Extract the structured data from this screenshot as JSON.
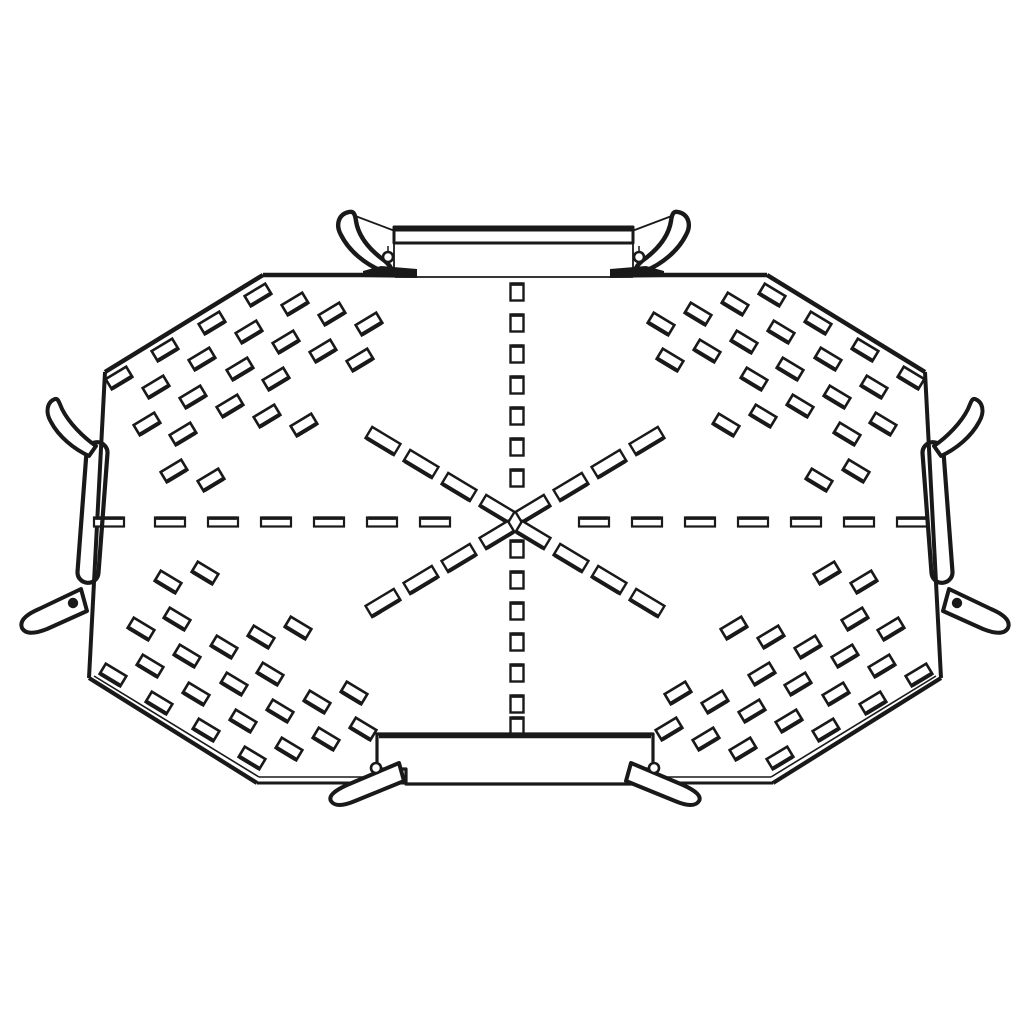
{
  "drawing": {
    "description": "black-and-white technical line illustration of a four-way perforated cable-tray crossover plate with edge couplers",
    "ink": "#191919",
    "background": "#ffffff",
    "canvas": {
      "width": 1030,
      "height": 1030
    },
    "outline_segments": [
      [
        263,
        275,
        395,
        275,
        4.5
      ],
      [
        633,
        275,
        767,
        275,
        4.5
      ],
      [
        395,
        277,
        633,
        277,
        1.8
      ],
      [
        263,
        275,
        105,
        372,
        4.5
      ],
      [
        767,
        275,
        925,
        372,
        4.5
      ],
      [
        105,
        372,
        89,
        678,
        4
      ],
      [
        925,
        372,
        941,
        678,
        4
      ],
      [
        89,
        678,
        257,
        783,
        4.2
      ],
      [
        941,
        678,
        773,
        783,
        4.2
      ],
      [
        94,
        676,
        259,
        777,
        1.6
      ],
      [
        936,
        676,
        771,
        777,
        1.6
      ],
      [
        259,
        777,
        771,
        777,
        1.6
      ],
      [
        257,
        783,
        773,
        783,
        3
      ]
    ],
    "corner_slots": {
      "w": 24,
      "h": 12,
      "stroke": 2.6,
      "accent": 4,
      "offsets": [
        [
          14,
          6
        ],
        [
          60,
          -22
        ],
        [
          107,
          -49
        ],
        [
          153,
          -77
        ],
        [
          51,
          15
        ],
        [
          97,
          -13
        ],
        [
          144,
          -40
        ],
        [
          190,
          -68
        ],
        [
          42,
          52
        ],
        [
          88,
          25
        ],
        [
          135,
          -3
        ],
        [
          181,
          -30
        ],
        [
          227,
          -58
        ],
        [
          78,
          62
        ],
        [
          125,
          34
        ],
        [
          171,
          7
        ],
        [
          218,
          -21
        ],
        [
          264,
          -48
        ],
        [
          69,
          99
        ],
        [
          162,
          44
        ],
        [
          255,
          -12
        ],
        [
          106,
          108
        ],
        [
          199,
          53
        ]
      ],
      "corners": [
        {
          "name": "top-left",
          "cx": 105,
          "cy": 372,
          "mx": 1,
          "my": 1,
          "ang": -31
        },
        {
          "name": "top-right",
          "cx": 925,
          "cy": 372,
          "mx": -1,
          "my": 1,
          "ang": 31
        },
        {
          "name": "bottom-left",
          "cx": 99,
          "cy": 681,
          "mx": 1,
          "my": -1,
          "ang": 31
        },
        {
          "name": "bottom-right",
          "cx": 933,
          "cy": 681,
          "mx": -1,
          "my": -1,
          "ang": -31
        }
      ]
    },
    "h_dashes": {
      "y": 522,
      "w": 30,
      "h": 9,
      "stroke": 2.2,
      "accent": 3.5,
      "x_starts": [
        94,
        155,
        208,
        261,
        314,
        367,
        420,
        579,
        632,
        685,
        738,
        791,
        844,
        897
      ]
    },
    "v_squares": {
      "x": 517,
      "w": 13,
      "h": 17,
      "stroke": 2.4,
      "accent": 3.5,
      "y_centers": [
        292,
        323,
        354,
        385,
        416,
        447,
        478,
        549,
        580,
        611,
        642,
        673,
        704,
        726
      ]
    },
    "diag_slots": {
      "w": 33,
      "h": 13,
      "stroke": 2.4,
      "accent": 4,
      "items": [
        [
          497,
          509,
          31
        ],
        [
          533,
          509,
          -31
        ],
        [
          497,
          535,
          -31
        ],
        [
          533,
          535,
          31
        ],
        [
          459,
          487,
          31
        ],
        [
          421,
          464,
          31
        ],
        [
          383,
          441,
          31
        ],
        [
          571,
          487,
          -31
        ],
        [
          609,
          464,
          -31
        ],
        [
          647,
          441,
          -31
        ],
        [
          459,
          558,
          -31
        ],
        [
          421,
          580,
          -31
        ],
        [
          383,
          603,
          -31
        ],
        [
          571,
          558,
          31
        ],
        [
          609,
          580,
          31
        ],
        [
          647,
          603,
          31
        ]
      ]
    },
    "bottom_coupler": [
      {
        "t": "path",
        "d": "M 377,734 L 653,734 L 653,769 L 638,769 L 638,784 L 406,784 L 406,769 L 377,769 Z",
        "f": "white",
        "w": 3.2
      },
      {
        "t": "line",
        "p": [
          379,
          736,
          651,
          736
        ],
        "w": 4.5
      },
      {
        "t": "path",
        "d": "M 399,763 L 347,785 Q 327,794 331,801 Q 336,809 355,801 L 404,781 Z",
        "f": "white",
        "w": 4
      },
      {
        "t": "path",
        "d": "M 631,763 L 683,785 Q 703,794 699,801 Q 694,809 675,801 L 626,781 Z",
        "f": "white",
        "w": 4
      },
      {
        "t": "circle",
        "c": [
          376,
          768
        ],
        "r": 5,
        "f": "white",
        "w": 2.6
      },
      {
        "t": "circle",
        "c": [
          654,
          768
        ],
        "r": 5,
        "f": "white",
        "w": 2.6
      }
    ],
    "top_coupler": [
      {
        "t": "line",
        "p": [
          394,
          243,
          394,
          275
        ],
        "w": 1.8
      },
      {
        "t": "line",
        "p": [
          633,
          243,
          633,
          275
        ],
        "w": 1.8
      },
      {
        "t": "line",
        "p": [
          388,
          246,
          388,
          270
        ],
        "w": 1.5
      },
      {
        "t": "line",
        "p": [
          639,
          246,
          639,
          270
        ],
        "w": 1.5
      },
      {
        "t": "line",
        "p": [
          350,
          214,
          395,
          231
        ],
        "w": 1.8
      },
      {
        "t": "line",
        "p": [
          677,
          214,
          632,
          231
        ],
        "w": 1.8
      },
      {
        "t": "path",
        "d": "M 394,227 L 633,227 L 633,243 L 394,243 Z",
        "f": "white",
        "w": 3
      },
      {
        "t": "line",
        "p": [
          394,
          229,
          633,
          229
        ],
        "w": 5
      },
      {
        "t": "path",
        "d": "M 349,212 C 339,214 335,224 341,235 C 349,251 365,264 382,271 L 391,273 C 393,268 388,263 381,258 C 367,247 358,234 356,221 C 355,213 353,211 349,212 Z",
        "f": "white",
        "w": 4.4
      },
      {
        "t": "path",
        "d": "M 678,212 C 688,214 692,224 686,235 C 678,251 662,264 645,271 L 636,273 C 634,268 639,263 646,258 C 660,247 669,234 671,221 C 672,213 674,211 678,212 Z",
        "f": "white",
        "w": 4.4
      },
      {
        "t": "poly",
        "pts": "363,277 363,271 381,266 417,269 417,278",
        "f": "ink"
      },
      {
        "t": "poly",
        "pts": "664,277 664,271 646,266 610,269 610,278",
        "f": "ink"
      },
      {
        "t": "circle",
        "c": [
          388,
          257
        ],
        "r": 5,
        "f": "white",
        "w": 2.6
      },
      {
        "t": "circle",
        "c": [
          639,
          257
        ],
        "r": 5,
        "f": "white",
        "w": 2.6
      }
    ],
    "left_connector": [
      {
        "t": "rect",
        "x": 82,
        "y": 442,
        "w": 21,
        "h": 141,
        "rx": 10.5,
        "rot": 4.3,
        "cx": 92.5,
        "cy": 512.5,
        "f": "none",
        "sw": 4.2
      },
      {
        "t": "path",
        "d": "M 55,399 C 47,402 45,412 51,422 C 59,437 74,449 89,456 L 96,446 C 83,437 69,423 62,409 C 59,402 58,398 55,399 Z",
        "f": "white",
        "w": 4
      },
      {
        "t": "path",
        "d": "M 81,589 L 39,609 Q 18,618 22,628 Q 27,637 47,629 L 87,611 Z",
        "f": "white",
        "w": 4
      },
      {
        "t": "circle",
        "c": [
          73,
          603
        ],
        "r": 5.2,
        "f": "ink",
        "w": 0
      }
    ],
    "right_connector": [
      {
        "t": "rect",
        "x": 927,
        "y": 442,
        "w": 21,
        "h": 141,
        "rx": 10.5,
        "rot": -4.3,
        "cx": 937.5,
        "cy": 512.5,
        "f": "none",
        "sw": 4.2
      },
      {
        "t": "path",
        "d": "M 975,399 C 983,402 985,412 979,422 C 971,437 956,449 941,456 L 934,446 C 947,437 961,423 968,409 C 971,402 972,398 975,399 Z",
        "f": "white",
        "w": 4
      },
      {
        "t": "path",
        "d": "M 949,589 L 991,609 Q 1012,618 1008,628 Q 1003,637 983,629 L 943,611 Z",
        "f": "white",
        "w": 4
      },
      {
        "t": "circle",
        "c": [
          957,
          603
        ],
        "r": 5.2,
        "f": "ink",
        "w": 0
      }
    ]
  }
}
